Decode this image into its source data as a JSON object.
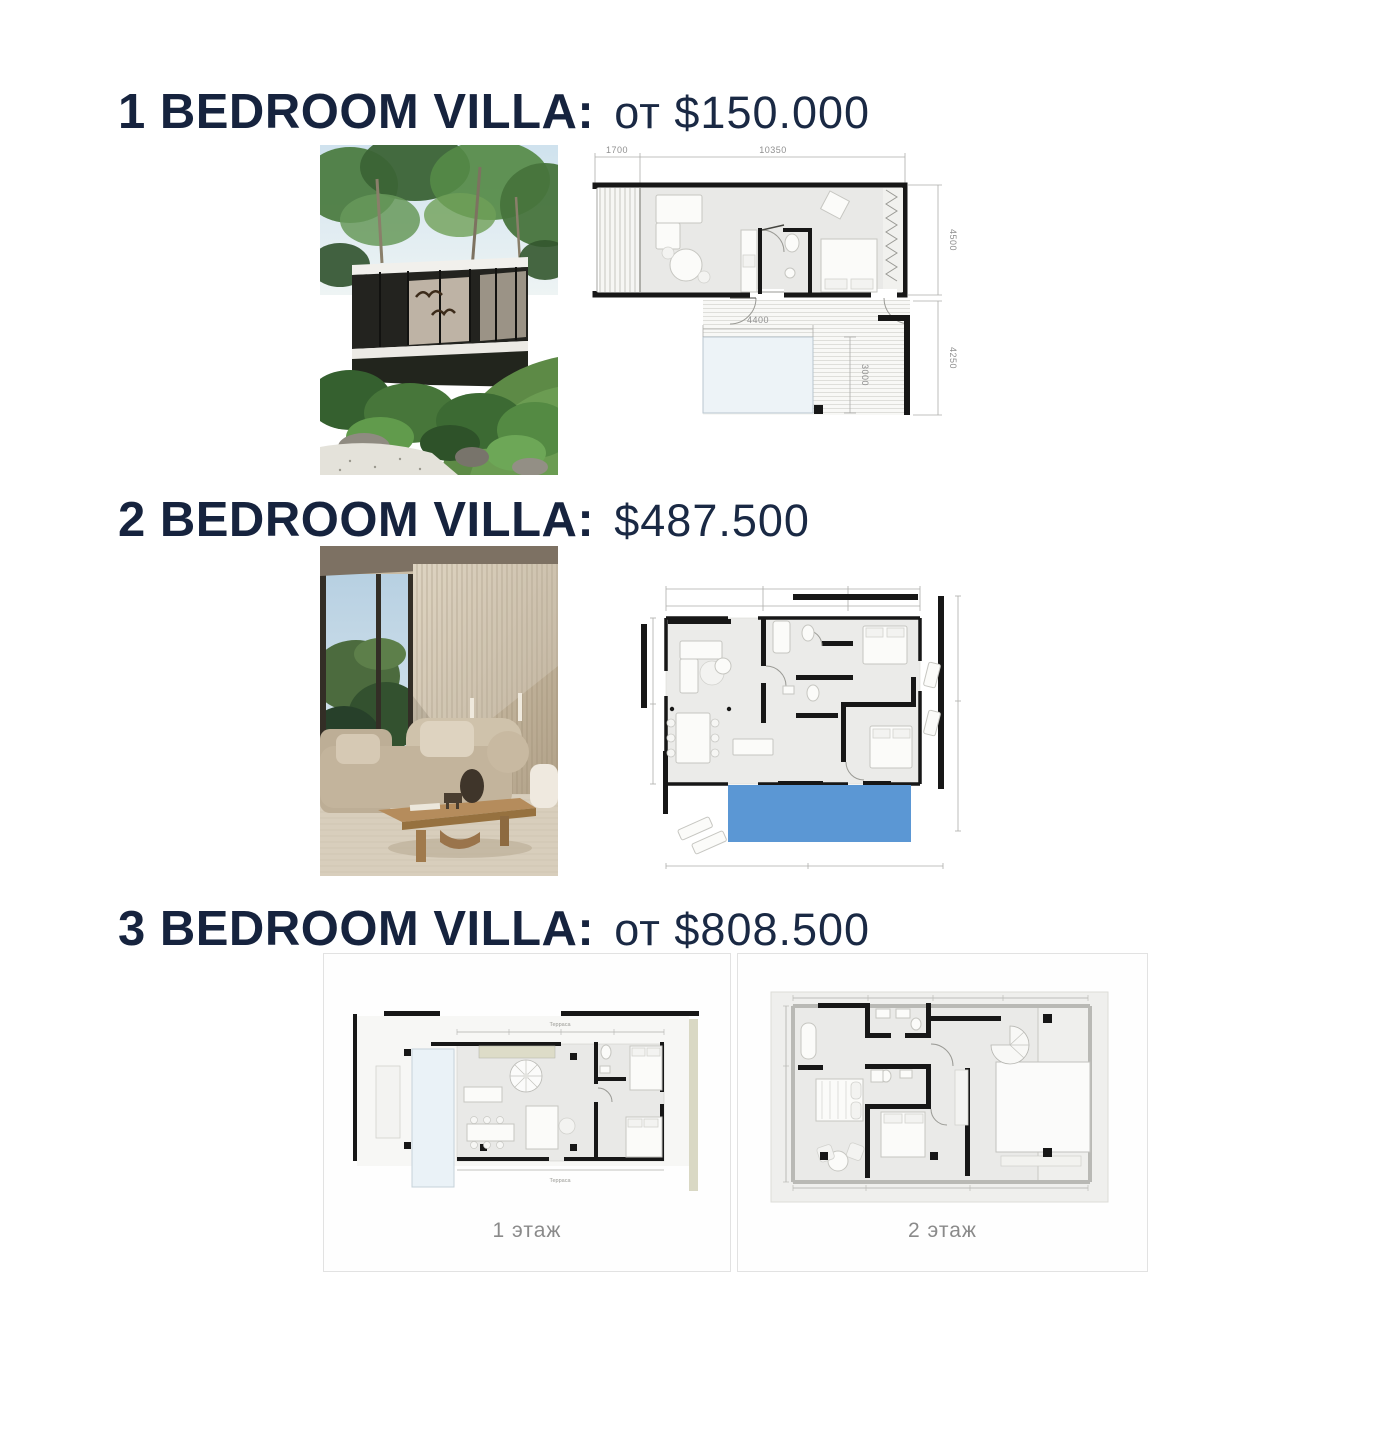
{
  "page_title": "Villa price list",
  "sections": [
    {
      "id": "1-bedroom-villa",
      "title": "1 BEDROOM VILLA:",
      "price": "от $150.000",
      "photo": "modern-glass-villa-in-jungle",
      "plan_dims": {
        "terrace_width": "1700",
        "building_width": "10350",
        "building_depth": "4500",
        "pool_width": "4400",
        "pool_depth": "3000",
        "patio_depth": "4250"
      }
    },
    {
      "id": "2-bedroom-villa",
      "title": "2 BEDROOM VILLA:",
      "price": "$487.500",
      "photo": "villa-living-room-interior"
    },
    {
      "id": "3-bedroom-villa",
      "title": "3 BEDROOM VILLA:",
      "price": "от $808.500",
      "floors": [
        {
          "label": "1 этаж",
          "terrace_label_top": "Терраса",
          "terrace_label_bottom": "Терраса"
        },
        {
          "label": "2 этаж"
        }
      ]
    }
  ],
  "colors": {
    "heading_navy": "#16233e",
    "dimension_gray": "#8f8f8f",
    "wall_black": "#171717",
    "floor_gray": "#e9e9e7",
    "pool_blue": "#5b97d4",
    "pool_pale": "#edf3f7",
    "card_border": "#e2e2e2",
    "label_gray": "#8a8a8a"
  }
}
